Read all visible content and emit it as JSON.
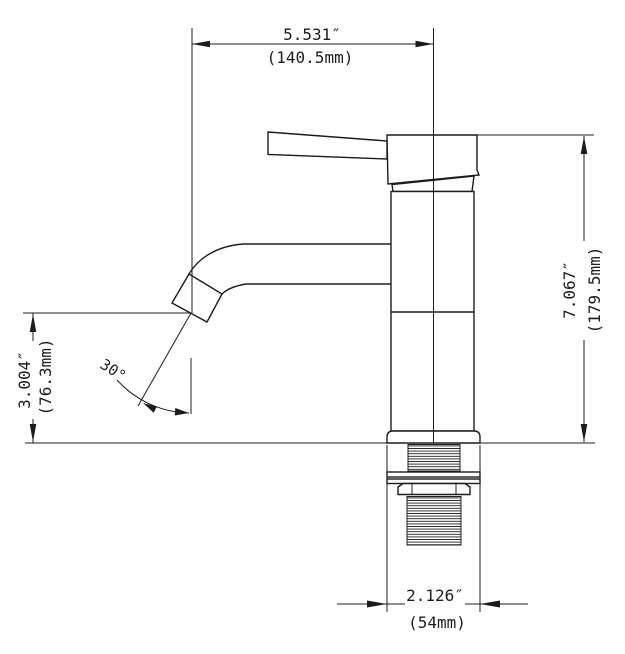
{
  "style": {
    "background": "#ffffff",
    "line_color": "#1c1c1c"
  },
  "dims": {
    "spout_reach": {
      "in": "5.531″",
      "mm": "(140.5mm)"
    },
    "overall_height": {
      "in": "7.067″",
      "mm": "(179.5mm)"
    },
    "spout_height": {
      "in": "3.004″",
      "mm": "(76.3mm)"
    },
    "base_width": {
      "in": "2.126″",
      "mm": "(54mm)"
    },
    "spout_angle": {
      "deg": "30°"
    }
  }
}
